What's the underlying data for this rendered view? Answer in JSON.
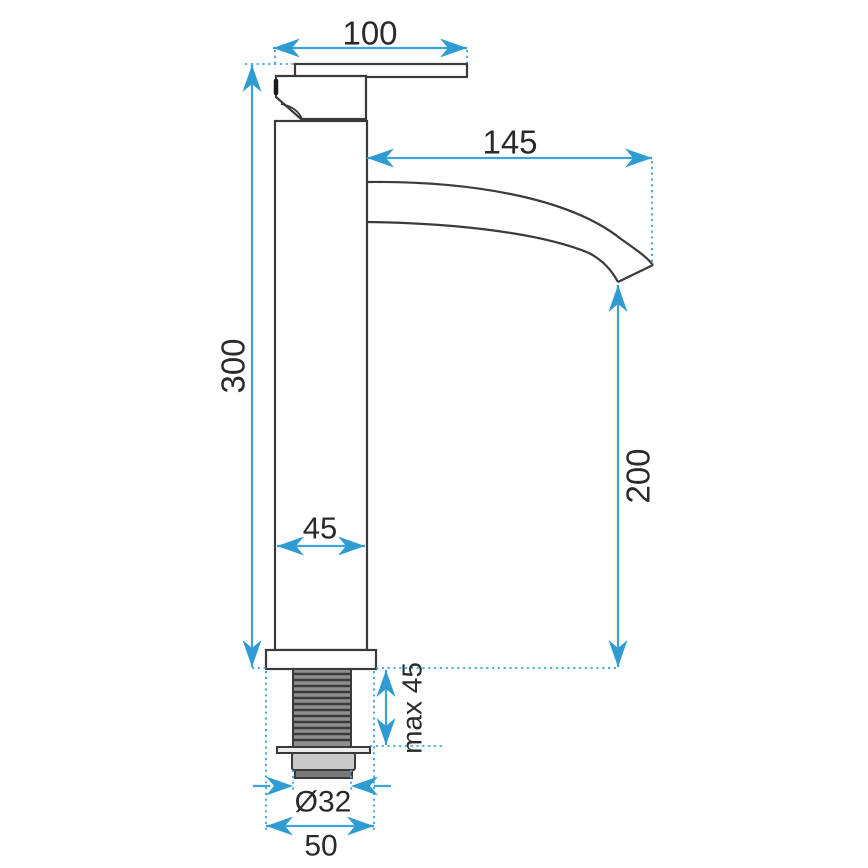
{
  "drawing": {
    "type": "technical-dimension-drawing",
    "subject": "tall single-lever basin faucet, side view"
  },
  "colors": {
    "dimension_blue": "#3ba4d9",
    "arrowhead_blue": "#2e9bd2",
    "outline_dark": "#3b3b3b",
    "text_dark": "#2a2a2a",
    "background": "#ffffff"
  },
  "dimensions": {
    "handle_width": "100",
    "spout_reach": "145",
    "body_height": "300",
    "body_width": "45",
    "outlet_height": "200",
    "max_mounting_thickness": "max 45",
    "thread_diameter": "Ø32",
    "base_diameter": "50"
  }
}
